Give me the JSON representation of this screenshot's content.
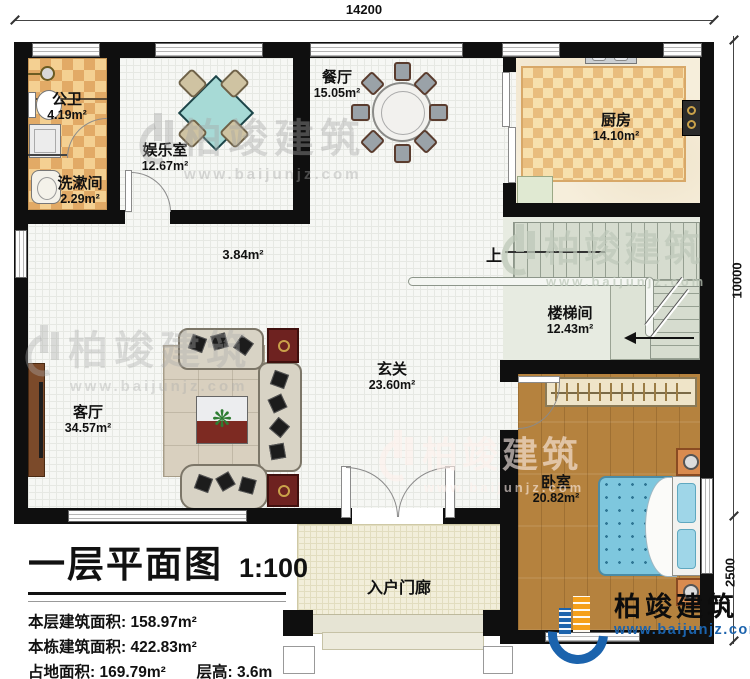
{
  "dimensions": {
    "top": "14200",
    "right_upper": "10000",
    "right_lower": "2500"
  },
  "rooms": [
    {
      "name": "公卫",
      "area": "4.19m²"
    },
    {
      "name": "洗漱间",
      "area": "2.29m²"
    },
    {
      "name": "娱乐室",
      "area": "12.67m²"
    },
    {
      "name": "餐厅",
      "area": "15.05m²"
    },
    {
      "name": "厨房",
      "area": "14.10m²"
    },
    {
      "name": "楼梯间",
      "area": "12.43m²"
    },
    {
      "name": "玄关",
      "area": "23.60m²"
    },
    {
      "name": "客厅",
      "area": "34.57m²"
    },
    {
      "name": "卧室",
      "area": "20.82m²"
    },
    {
      "name": "入户门廊",
      "area": ""
    }
  ],
  "annotations": {
    "corridor_area": "3.84m²",
    "stairs_up": "上"
  },
  "title_block": {
    "title": "一层平面图",
    "scale": "1:100",
    "stats": [
      {
        "label": "本层建筑面积:",
        "value": "158.97m²"
      },
      {
        "label": "本栋建筑面积:",
        "value": "422.83m²"
      },
      {
        "label": "占地面积:",
        "value": "169.79m²"
      },
      {
        "label": "层高:",
        "value": "3.6m"
      }
    ]
  },
  "branding": {
    "company": "柏竣建筑",
    "website": "www.baijunjz.com"
  },
  "watermark": {
    "company": "柏竣建筑",
    "website": "www.baijunjz.com"
  },
  "colors": {
    "wall": "#0f0f0f",
    "brand_blue": "#1b63ad",
    "brand_orange": "#f5a01a",
    "bed_blue": "#7ec7de",
    "wood": "#b5823e",
    "tile_orange": "#e2aa66"
  }
}
